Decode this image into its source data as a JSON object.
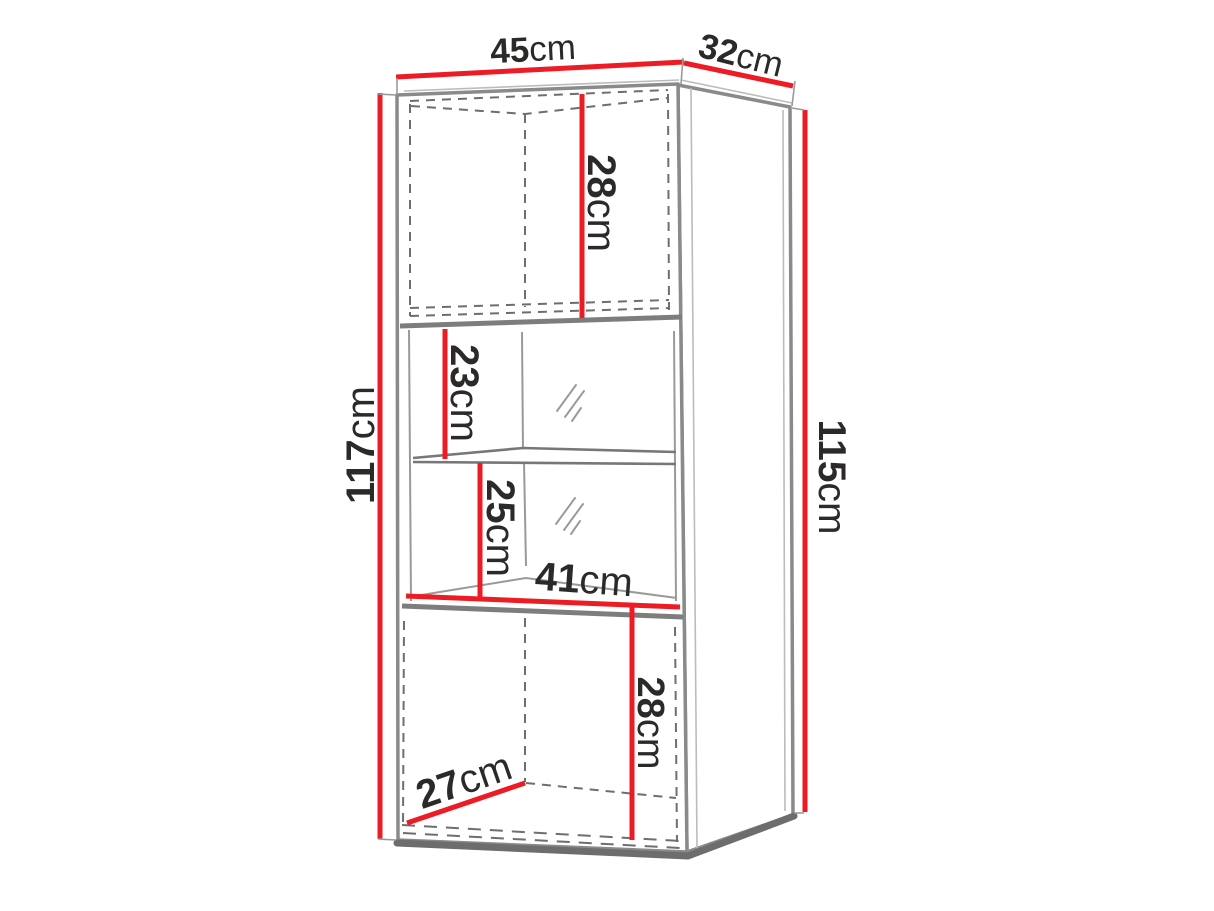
{
  "diagram": {
    "type": "furniture-dimension-diagram",
    "background": "#ffffff",
    "colors": {
      "dimension_line": "#ed1c24",
      "edge_line": "#8a8a8a",
      "hidden_line": "#6e6e6e",
      "label_text": "#2b2a29"
    },
    "dimensions": {
      "top_width": {
        "value": "45",
        "unit": "cm"
      },
      "top_depth": {
        "value": "32",
        "unit": "cm"
      },
      "left_height": {
        "value": "117",
        "unit": "cm"
      },
      "right_height": {
        "value": "115",
        "unit": "cm"
      },
      "upper_cabinet_inner_height": {
        "value": "28",
        "unit": "cm"
      },
      "upper_shelf_space_height": {
        "value": "23",
        "unit": "cm"
      },
      "lower_shelf_space_height": {
        "value": "25",
        "unit": "cm"
      },
      "inner_width": {
        "value": "41",
        "unit": "cm"
      },
      "lower_cabinet_inner_height": {
        "value": "28",
        "unit": "cm"
      },
      "lower_cabinet_inner_depth": {
        "value": "27",
        "unit": "cm"
      }
    }
  }
}
